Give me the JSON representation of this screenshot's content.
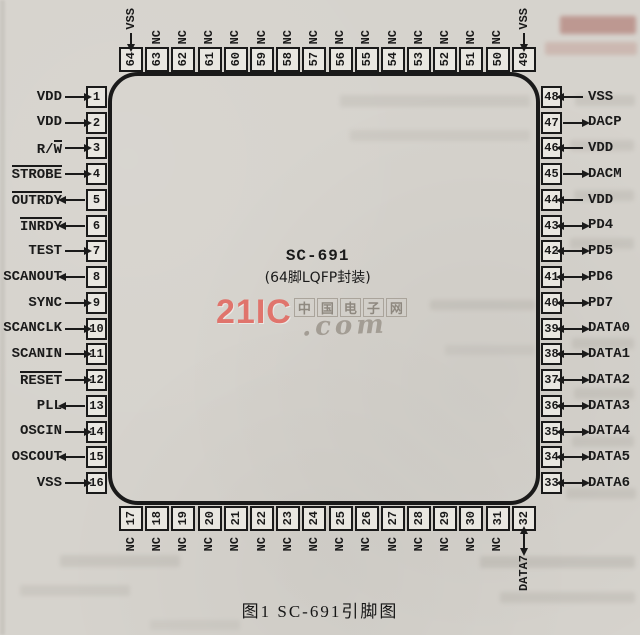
{
  "page": {
    "bg": "#d6d3cd",
    "ink": "#1a1a1a"
  },
  "chip": {
    "name": "SC-691",
    "package": "(64脚LQFP封装)"
  },
  "caption": "图1  SC-691引脚图",
  "watermark": {
    "logo": "21IC",
    "domain": ".com",
    "cn": "中国电子网",
    "logo_color": "#e0746c",
    "gray_color": "#a39d94"
  },
  "pins": {
    "left": [
      {
        "num": "1",
        "plain": "VDD",
        "over": "",
        "dir": "in"
      },
      {
        "num": "2",
        "plain": "VDD",
        "over": "",
        "dir": "in"
      },
      {
        "num": "3",
        "plain": "R/",
        "over": "W",
        "dir": "in"
      },
      {
        "num": "4",
        "plain": "",
        "over": "STROBE",
        "dir": "in"
      },
      {
        "num": "5",
        "plain": "",
        "over": "OUTRDY",
        "dir": "out"
      },
      {
        "num": "6",
        "plain": "",
        "over": "INRDY",
        "dir": "out"
      },
      {
        "num": "7",
        "plain": "TEST",
        "over": "",
        "dir": "in"
      },
      {
        "num": "8",
        "plain": "SCANOUT",
        "over": "",
        "dir": "out"
      },
      {
        "num": "9",
        "plain": "SYNC",
        "over": "",
        "dir": "in"
      },
      {
        "num": "10",
        "plain": "SCANCLK",
        "over": "",
        "dir": "in"
      },
      {
        "num": "11",
        "plain": "SCANIN",
        "over": "",
        "dir": "in"
      },
      {
        "num": "12",
        "plain": "",
        "over": "RESET",
        "dir": "in"
      },
      {
        "num": "13",
        "plain": "PLL",
        "over": "",
        "dir": "out"
      },
      {
        "num": "14",
        "plain": "OSCIN",
        "over": "",
        "dir": "in"
      },
      {
        "num": "15",
        "plain": "OSCOUT",
        "over": "",
        "dir": "out"
      },
      {
        "num": "16",
        "plain": "VSS",
        "over": "",
        "dir": "in"
      }
    ],
    "right": [
      {
        "num": "48",
        "plain": "VSS",
        "over": "",
        "dir": "in"
      },
      {
        "num": "47",
        "plain": "DACP",
        "over": "",
        "dir": "out"
      },
      {
        "num": "46",
        "plain": "VDD",
        "over": "",
        "dir": "in"
      },
      {
        "num": "45",
        "plain": "DACM",
        "over": "",
        "dir": "out"
      },
      {
        "num": "44",
        "plain": "VDD",
        "over": "",
        "dir": "in"
      },
      {
        "num": "43",
        "plain": "PD4",
        "over": "",
        "dir": "bi"
      },
      {
        "num": "42",
        "plain": "PD5",
        "over": "",
        "dir": "bi"
      },
      {
        "num": "41",
        "plain": "PD6",
        "over": "",
        "dir": "bi"
      },
      {
        "num": "40",
        "plain": "PD7",
        "over": "",
        "dir": "bi"
      },
      {
        "num": "39",
        "plain": "DATA0",
        "over": "",
        "dir": "bi"
      },
      {
        "num": "38",
        "plain": "DATA1",
        "over": "",
        "dir": "bi"
      },
      {
        "num": "37",
        "plain": "DATA2",
        "over": "",
        "dir": "bi"
      },
      {
        "num": "36",
        "plain": "DATA3",
        "over": "",
        "dir": "bi"
      },
      {
        "num": "35",
        "plain": "DATA4",
        "over": "",
        "dir": "bi"
      },
      {
        "num": "34",
        "plain": "DATA5",
        "over": "",
        "dir": "bi"
      },
      {
        "num": "33",
        "plain": "DATA6",
        "over": "",
        "dir": "bi"
      }
    ],
    "top": [
      {
        "num": "64",
        "label": "VSS",
        "dir": "in"
      },
      {
        "num": "63",
        "label": "NC",
        "dir": "nc"
      },
      {
        "num": "62",
        "label": "NC",
        "dir": "nc"
      },
      {
        "num": "61",
        "label": "NC",
        "dir": "nc"
      },
      {
        "num": "60",
        "label": "NC",
        "dir": "nc"
      },
      {
        "num": "59",
        "label": "NC",
        "dir": "nc"
      },
      {
        "num": "58",
        "label": "NC",
        "dir": "nc"
      },
      {
        "num": "57",
        "label": "NC",
        "dir": "nc"
      },
      {
        "num": "56",
        "label": "NC",
        "dir": "nc"
      },
      {
        "num": "55",
        "label": "NC",
        "dir": "nc"
      },
      {
        "num": "54",
        "label": "NC",
        "dir": "nc"
      },
      {
        "num": "53",
        "label": "NC",
        "dir": "nc"
      },
      {
        "num": "52",
        "label": "NC",
        "dir": "nc"
      },
      {
        "num": "51",
        "label": "NC",
        "dir": "nc"
      },
      {
        "num": "50",
        "label": "NC",
        "dir": "nc"
      },
      {
        "num": "49",
        "label": "VSS",
        "dir": "in"
      }
    ],
    "bottom": [
      {
        "num": "17",
        "label": "NC",
        "dir": "nc"
      },
      {
        "num": "18",
        "label": "NC",
        "dir": "nc"
      },
      {
        "num": "19",
        "label": "NC",
        "dir": "nc"
      },
      {
        "num": "20",
        "label": "NC",
        "dir": "nc"
      },
      {
        "num": "21",
        "label": "NC",
        "dir": "nc"
      },
      {
        "num": "22",
        "label": "NC",
        "dir": "nc"
      },
      {
        "num": "23",
        "label": "NC",
        "dir": "nc"
      },
      {
        "num": "24",
        "label": "NC",
        "dir": "nc"
      },
      {
        "num": "25",
        "label": "NC",
        "dir": "nc"
      },
      {
        "num": "26",
        "label": "NC",
        "dir": "nc"
      },
      {
        "num": "27",
        "label": "NC",
        "dir": "nc"
      },
      {
        "num": "28",
        "label": "NC",
        "dir": "nc"
      },
      {
        "num": "29",
        "label": "NC",
        "dir": "nc"
      },
      {
        "num": "30",
        "label": "NC",
        "dir": "nc"
      },
      {
        "num": "31",
        "label": "NC",
        "dir": "nc"
      },
      {
        "num": "32",
        "label": "DATA7",
        "dir": "bi"
      }
    ]
  }
}
